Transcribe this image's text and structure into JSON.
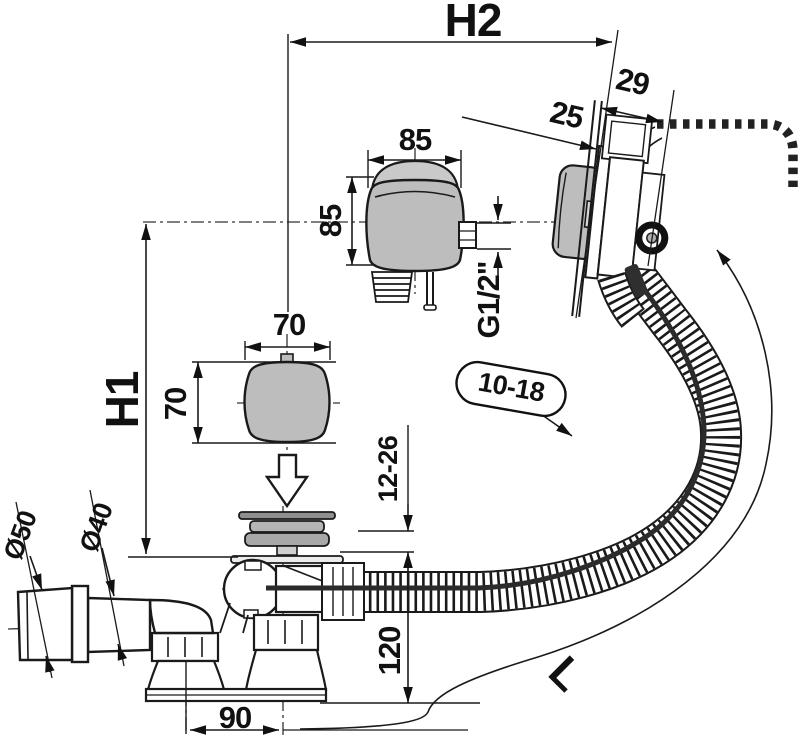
{
  "page": {
    "background": "#ffffff"
  },
  "drawing": {
    "type": "technical-dimension-drawing",
    "subject": "bathtub waste, overflow and filling set with bowden cable, sectional side view",
    "colors": {
      "line": "#1a1a1a",
      "part_gray": "#bdbdbd",
      "dome_gray": "#c9c9c9",
      "plug_gray": "#a8a8a8",
      "cable_dark": "#2b2b2b",
      "background": "#ffffff"
    },
    "labels": {
      "height_overflow": "H2",
      "height_waste": "H1",
      "overflow_depth_outer": "29",
      "overflow_depth_inner": "25",
      "knob_width": "85",
      "knob_height": "85",
      "thread": "G1/2\"",
      "button_width": "70",
      "button_height": "70",
      "wall_thickness_range": "10-18",
      "floor_thickness_range": "12-26",
      "waste_height": "120",
      "outlet_offset": "90",
      "outlet_diameter": "Ø50",
      "pipe_diameter": "Ø40",
      "hose_length": "L"
    }
  }
}
